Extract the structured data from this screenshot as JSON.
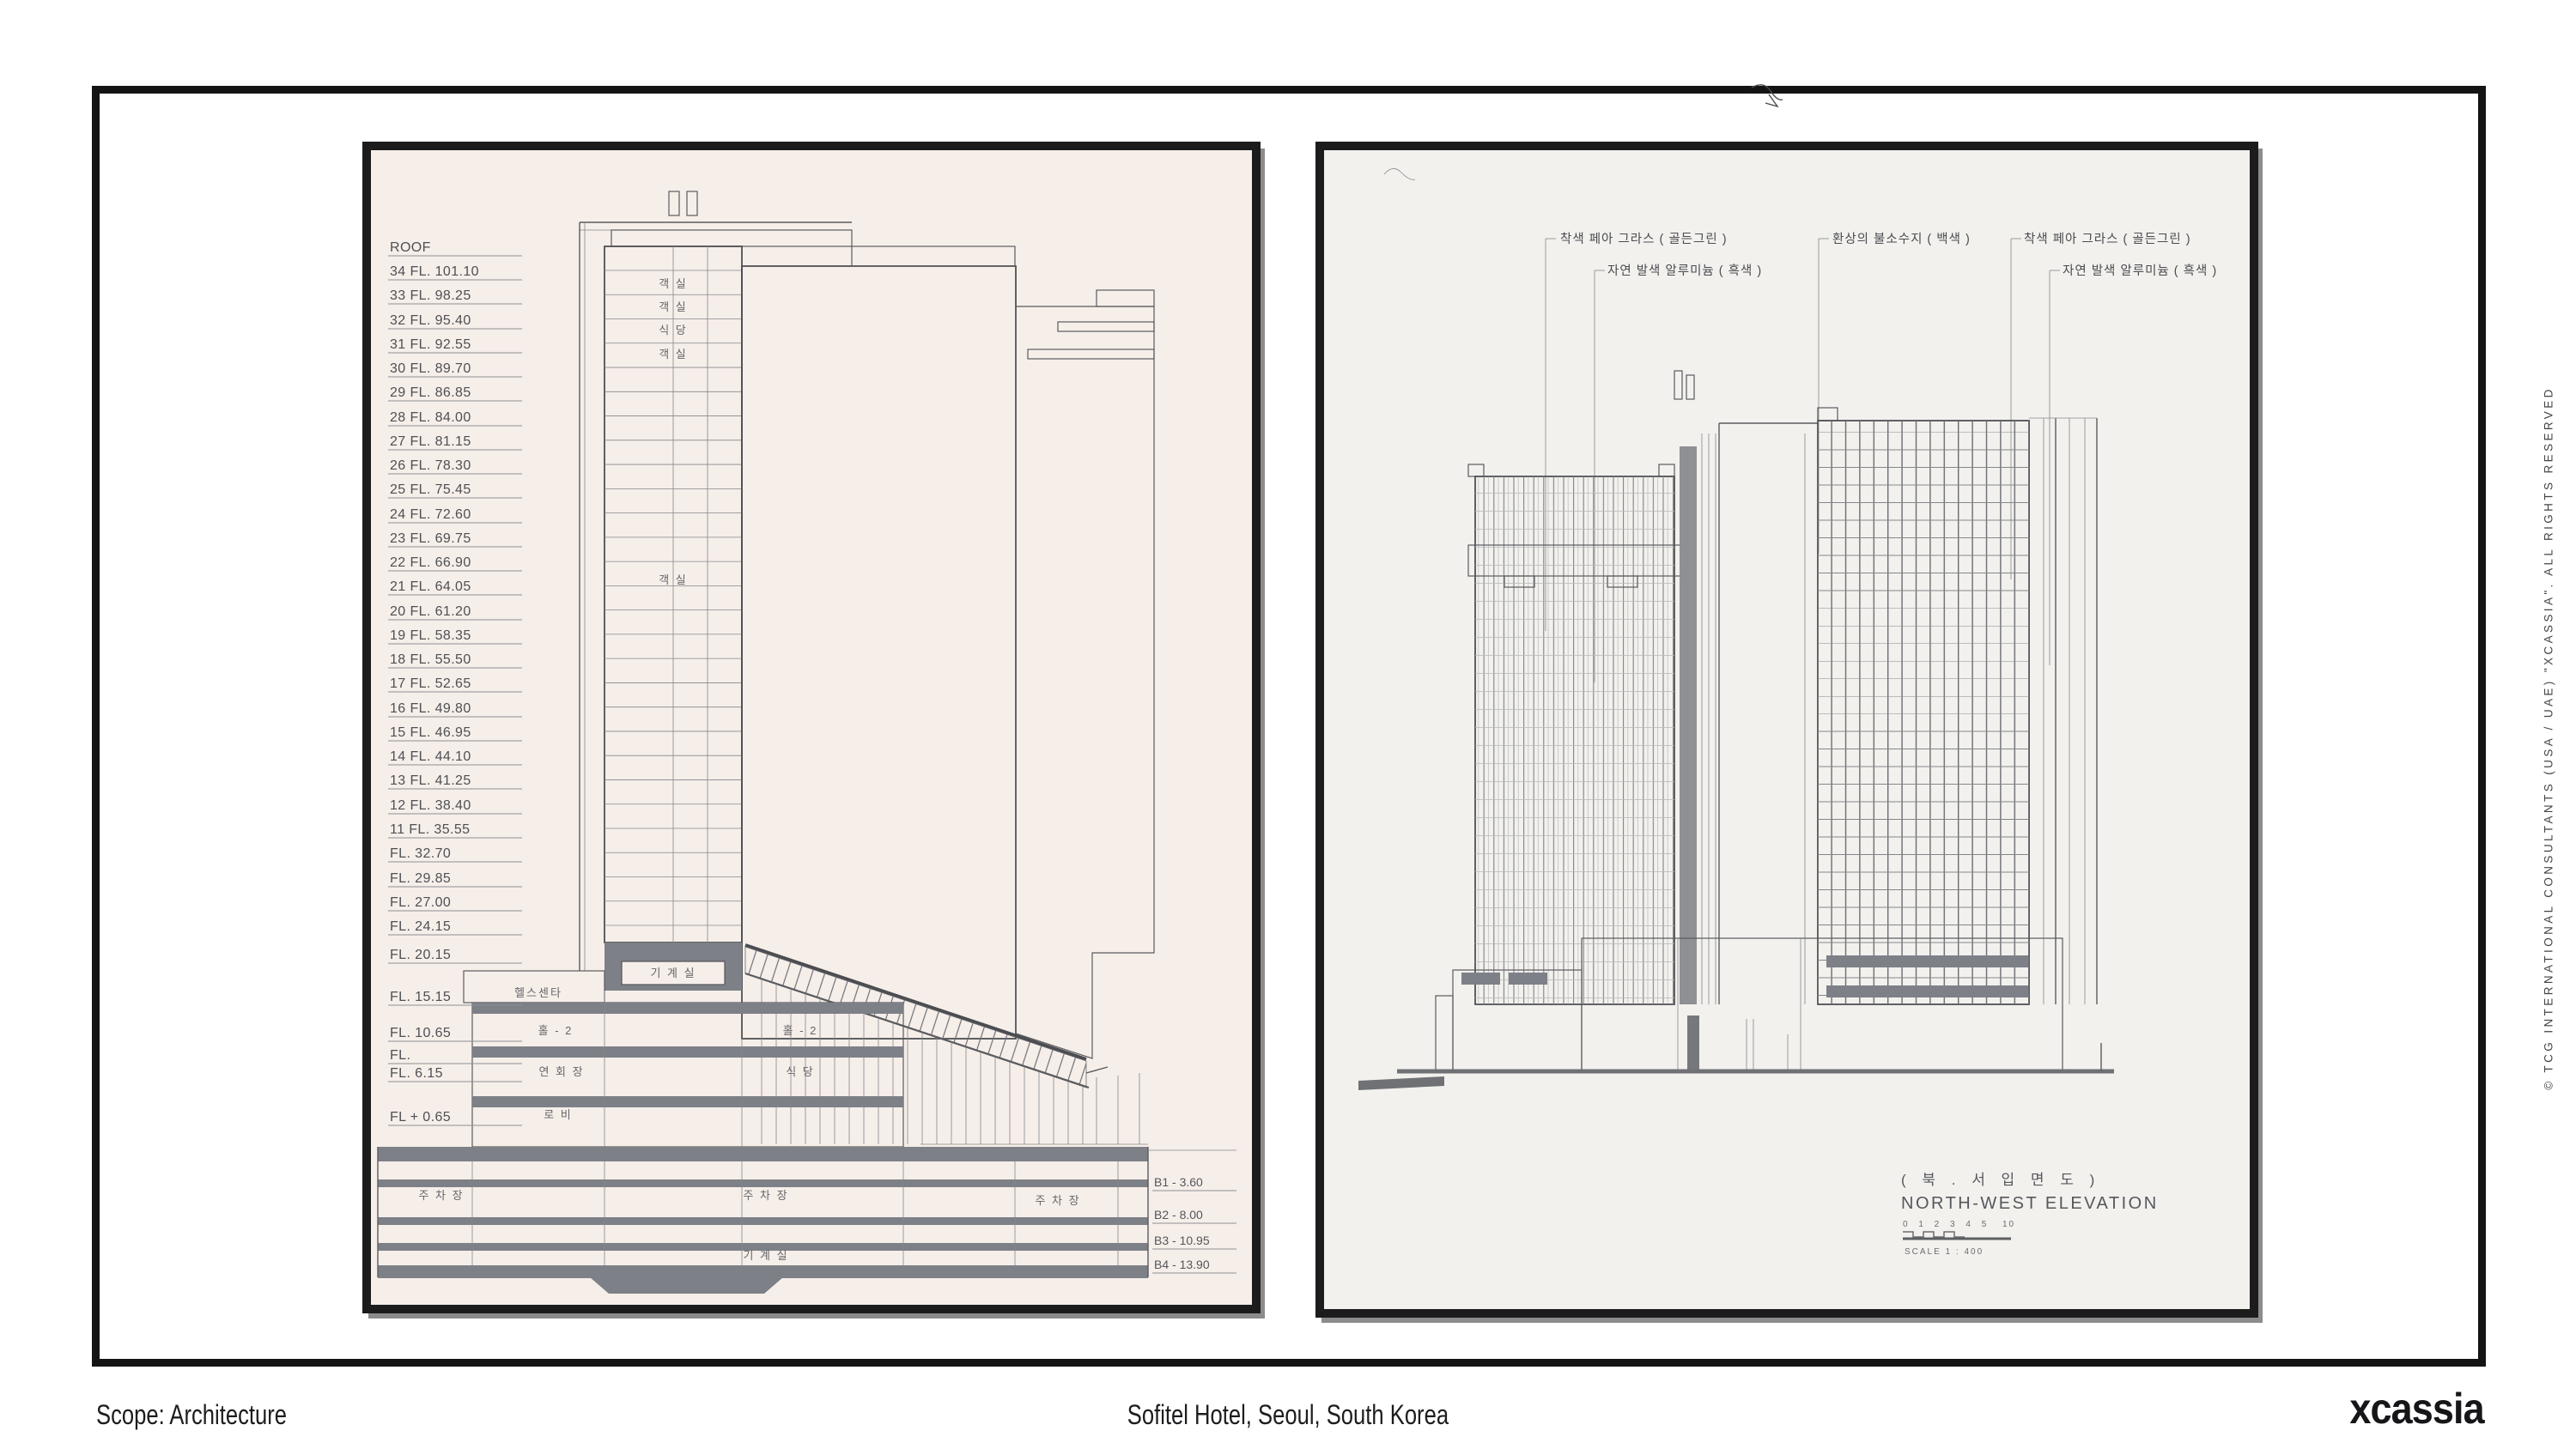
{
  "footer": {
    "scope_label": "Scope: Architecture",
    "project_label": "Sofitel Hotel, Seoul, South Korea",
    "logo_text": "xcassia"
  },
  "sidebar": {
    "copyright_text": "© TCG INTERNATIONAL CONSULTANTS (USA / UAE) \"XCASSIA\". ALL RIGHTS RESERVED"
  },
  "colors": {
    "frame": "#141414",
    "paper_left": "#f6eee9",
    "paper_right": "#f3f1ee",
    "ink": "#595b5f",
    "slab": "#7d8087"
  },
  "left_drawing": {
    "floor_labels": [
      "ROOF",
      "34 FL. 101.10",
      "33 FL. 98.25",
      "32 FL. 95.40",
      "31 FL. 92.55",
      "30 FL. 89.70",
      "29 FL. 86.85",
      "28 FL. 84.00",
      "27 FL. 81.15",
      "26 FL. 78.30",
      "25 FL. 75.45",
      "24 FL. 72.60",
      "23 FL. 69.75",
      "22 FL. 66.90",
      "21 FL. 64.05",
      "20 FL. 61.20",
      "19 FL. 58.35",
      "18 FL. 55.50",
      "17 FL. 52.65",
      "16 FL. 49.80",
      "15 FL. 46.95",
      "14 FL. 44.10",
      "13 FL. 41.25",
      "12 FL. 38.40",
      "11 FL. 35.55",
      "FL. 32.70",
      "FL. 29.85",
      "FL. 27.00",
      "FL. 24.15",
      "FL. 20.15",
      "FL. 15.15",
      "FL. 10.65",
      "FL.",
      "FL. 6.15",
      "FL + 0.65"
    ],
    "basement_labels": [
      "B1 - 3.60",
      "B2 - 8.00",
      "B3 - 10.95",
      "B4 - 13.90"
    ],
    "room_labels": [
      "객 실",
      "객 실",
      "식 당",
      "객 실",
      "객 실",
      "기 계 실",
      "헬스센타",
      "홀 - 2",
      "홀 - 2",
      "연 회 장",
      "식 당",
      "로 비",
      "주 차 장",
      "주 차 장",
      "주 차 장",
      "기 계 실"
    ]
  },
  "right_drawing": {
    "annotations": [
      "착색 페아 그라스 ( 골든그린 )",
      "자연 발색 알루미늄 ( 흑색 )",
      "환상의 불소수지 ( 백색 )",
      "착색 페아 그라스 ( 골든그린 )",
      "자연 발색 알루미늄 ( 흑색 )"
    ],
    "title_korean": "( 북 . 서  입 면 도 )",
    "title_english": "NORTH-WEST  ELEVATION",
    "scale_ticks": "0 1 2 3 4 5",
    "scale_end": "10",
    "scale_label": "SCALE  1 : 400"
  }
}
